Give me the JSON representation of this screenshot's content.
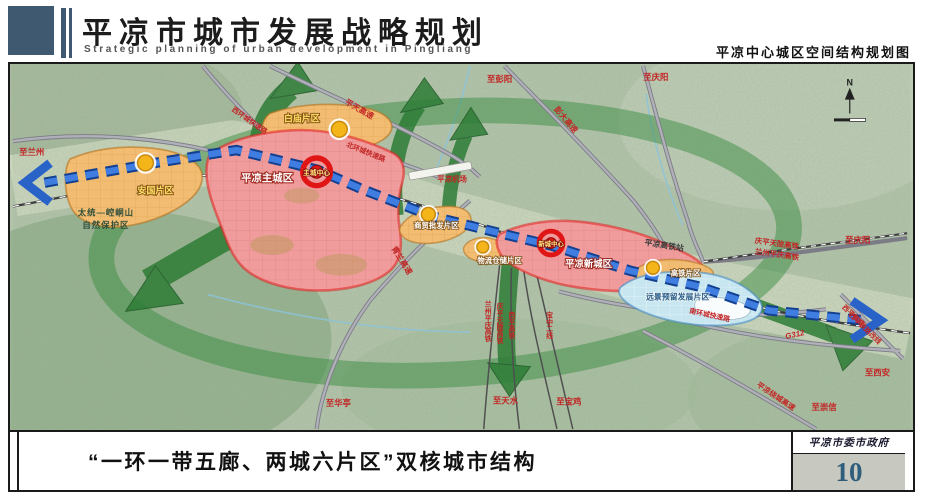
{
  "header": {
    "title": "平凉市城市发展战略规划",
    "subtitle_en": "Strategic planning of urban development in Pingliang",
    "map_title": "平凉中心城区空间结构规划图"
  },
  "footer": {
    "caption": "“一环一带五廊、两城六片区”双核城市结构",
    "agency": "平凉市委市政府",
    "page": "10"
  },
  "map": {
    "compass": "N",
    "zones": [
      {
        "id": "anguo",
        "label": "安国片区",
        "type": "district"
      },
      {
        "id": "baimiao",
        "label": "白庙片区",
        "type": "district"
      },
      {
        "id": "main-city",
        "label": "平凉主城区",
        "core": "主城中心",
        "type": "city"
      },
      {
        "id": "shangmao",
        "label": "商贸批发片区",
        "type": "district"
      },
      {
        "id": "cangchu",
        "label": "物流仓储片区",
        "type": "district"
      },
      {
        "id": "new-city",
        "label": "平凉新城区",
        "core": "新城中心",
        "type": "city"
      },
      {
        "id": "gaotie",
        "label": "高铁片区",
        "type": "district"
      },
      {
        "id": "reserve",
        "label": "远景预留发展片区",
        "type": "reserve"
      }
    ],
    "poi": [
      {
        "id": "airport",
        "label": "平凉机场"
      },
      {
        "id": "hsr-station",
        "label": "平凉高铁站"
      },
      {
        "id": "nature-reserve-line1",
        "label": "太统—崆峒山"
      },
      {
        "id": "nature-reserve-line2",
        "label": "自然保护区"
      }
    ],
    "roads": [
      {
        "label": "彭大高速"
      },
      {
        "label": "平天高速"
      },
      {
        "label": "西环城快速路"
      },
      {
        "label": "北环城快速路"
      },
      {
        "label": "青兰高速"
      },
      {
        "label": "南环城快速路"
      },
      {
        "label": "G312"
      },
      {
        "label": "平凉绕城高速"
      },
      {
        "label": "西平高速"
      },
      {
        "label": "西平铁路改线"
      },
      {
        "label": "庆平天陇高铁"
      },
      {
        "label": "兰州平庆高铁"
      }
    ],
    "railways": [
      {
        "label": "兰州平庆高铁"
      },
      {
        "label": "庆平天陇高铁"
      },
      {
        "label": "西平高铁"
      },
      {
        "label": "宝中二线"
      }
    ],
    "destinations": [
      {
        "label": "至兰州"
      },
      {
        "label": "至彭阳"
      },
      {
        "label": "至庆阳"
      },
      {
        "label": "至庆阳"
      },
      {
        "label": "至华亭"
      },
      {
        "label": "至天水"
      },
      {
        "label": "至宝鸡"
      },
      {
        "label": "至西安"
      },
      {
        "label": "至崇信"
      }
    ]
  },
  "colors": {
    "header_accent": "#3f5a70",
    "corridor_green": "#2e7d36",
    "belt_blue": "#2a63c8",
    "city_red": "#e31e1e",
    "district_orange": "#f2bd72",
    "reserve_blue": "#3f87c4",
    "page_number_blue": "#2f5d7c"
  }
}
